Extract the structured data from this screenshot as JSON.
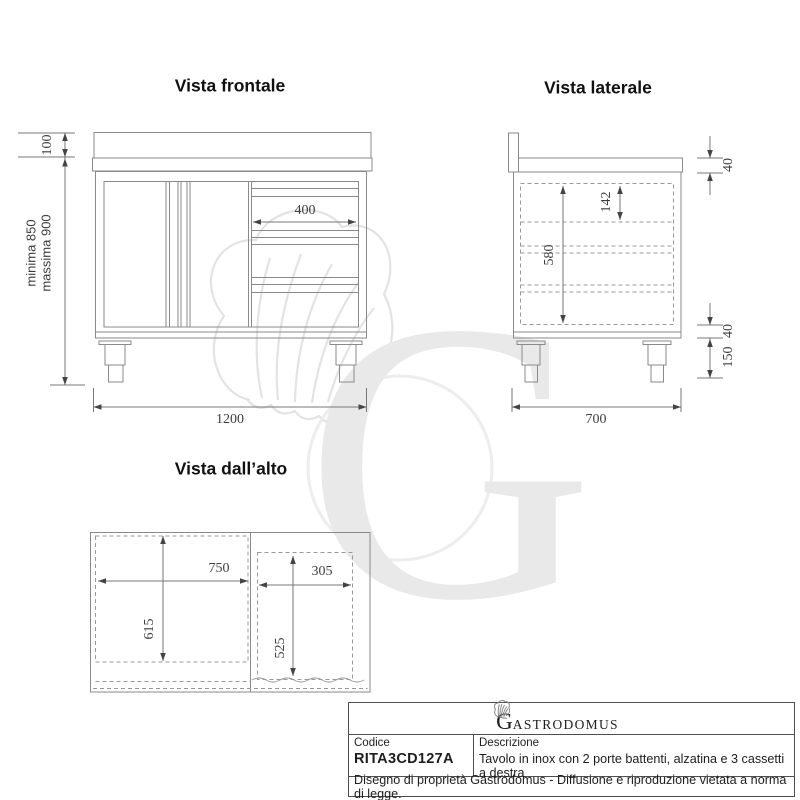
{
  "views": {
    "front": {
      "title": "Vista frontale",
      "alzatina_height": "100",
      "min_height": "minima 850",
      "max_height": "massima 900",
      "drawer_width": "400",
      "total_width": "1200"
    },
    "side": {
      "title": "Vista laterale",
      "top_thickness": "40",
      "first_drawer_depth": "142",
      "body_height": "580",
      "base_frame": "40",
      "leg_height": "150",
      "total_depth": "700"
    },
    "top": {
      "title": "Vista dall’alto",
      "left_width": "750",
      "left_depth": "615",
      "right_width": "305",
      "right_depth": "525"
    }
  },
  "title_block": {
    "logo_initial": "G",
    "logo_rest": "ASTRODOMUS",
    "codice_label": "Codice",
    "codice_value": "RITA3CD127A",
    "descrizione_label": "Descrizione",
    "descrizione_value": "Tavolo in inox con 2 porte battenti, alzatina e 3 cassetti a destra",
    "footer": "Disegno di proprietà Gastrodomus -  Diffusione e riproduzione vietata a norma di legge."
  },
  "watermark": {
    "letter": "G"
  },
  "colors": {
    "drawing_line": "#8a8a8a",
    "dimension_line": "#777777",
    "dashed_line": "#999999",
    "dimension_text": "#3d3d3d",
    "watermark": "#e6e6e6"
  }
}
